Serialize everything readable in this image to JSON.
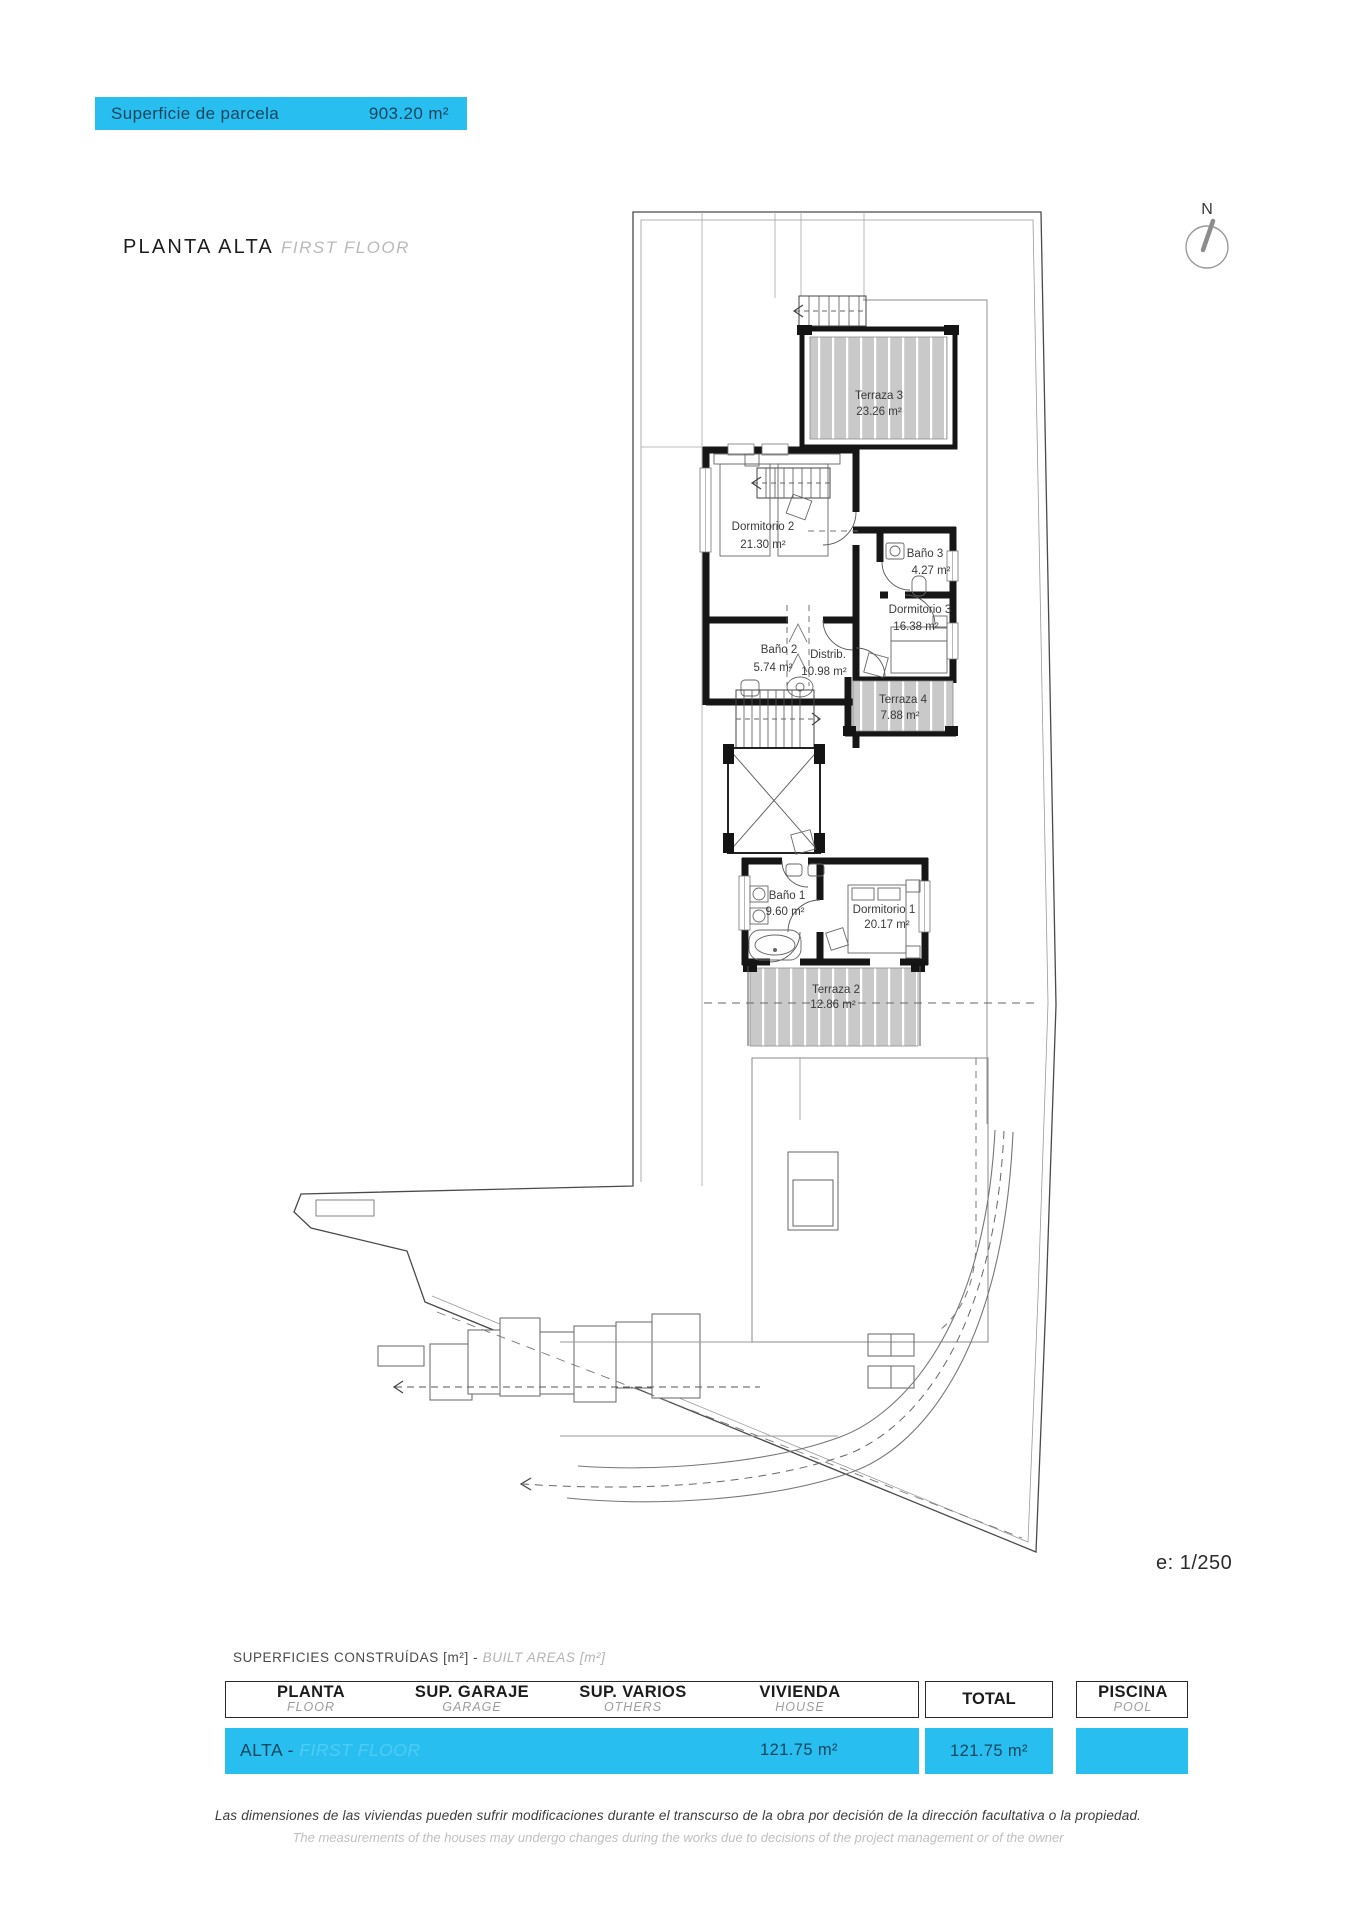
{
  "banner": {
    "label": "Superficie de parcela",
    "value": "903.20 m²",
    "accent": "#29bef0"
  },
  "heading": {
    "title": "PLANTA ALTA",
    "subtitle": "FIRST FLOOR"
  },
  "north_indicator": {
    "label": "N"
  },
  "plan": {
    "scale_label": "e: 1/250",
    "rooms": [
      {
        "label": "Terraza 3",
        "area": "23.26 m²"
      },
      {
        "label": "Dormitorio 2",
        "area": "21.30 m²"
      },
      {
        "label": "Baño 2",
        "area": "5.74 m²"
      },
      {
        "label": "Baño 3",
        "area": "4.27 m²"
      },
      {
        "label": "Dormitorio 3",
        "area": "16.38 m²"
      },
      {
        "label": "Distrib.",
        "area": "10.98 m²"
      },
      {
        "label": "Terraza 4",
        "area": "7.88 m²"
      },
      {
        "label": "Baño 1",
        "area": "9.60 m²"
      },
      {
        "label": "Dormitorio 1",
        "area": "20.17 m²"
      },
      {
        "label": "Terraza 2",
        "area": "12.86 m²"
      }
    ]
  },
  "areas_table": {
    "caption_es": "SUPERFICIES CONSTRUÍDAS [m²] - ",
    "caption_en": "BUILT AREAS [m²]",
    "columns": [
      {
        "label": "PLANTA",
        "sublabel": "FLOOR"
      },
      {
        "label": "SUP. GARAJE",
        "sublabel": "GARAGE"
      },
      {
        "label": "SUP. VARIOS",
        "sublabel": "OTHERS"
      },
      {
        "label": "VIVIENDA",
        "sublabel": "HOUSE"
      },
      {
        "label": "TOTAL",
        "sublabel": ""
      },
      {
        "label": "PISCINA",
        "sublabel": "POOL"
      }
    ],
    "row": {
      "floor": "ALTA - ",
      "floor_ghost": "FIRST FLOOR",
      "house": "121.75 m²",
      "total": "121.75 m²",
      "pool": ""
    },
    "accent": "#29bef0"
  },
  "disclaimer": {
    "es": "Las dimensiones de las viviendas pueden sufrir modificaciones durante el transcurso de la obra por decisión de la dirección facultativa o la propiedad.",
    "en": "The measurements of the houses may undergo changes during the works due to decisions of the project management or of the owner"
  }
}
